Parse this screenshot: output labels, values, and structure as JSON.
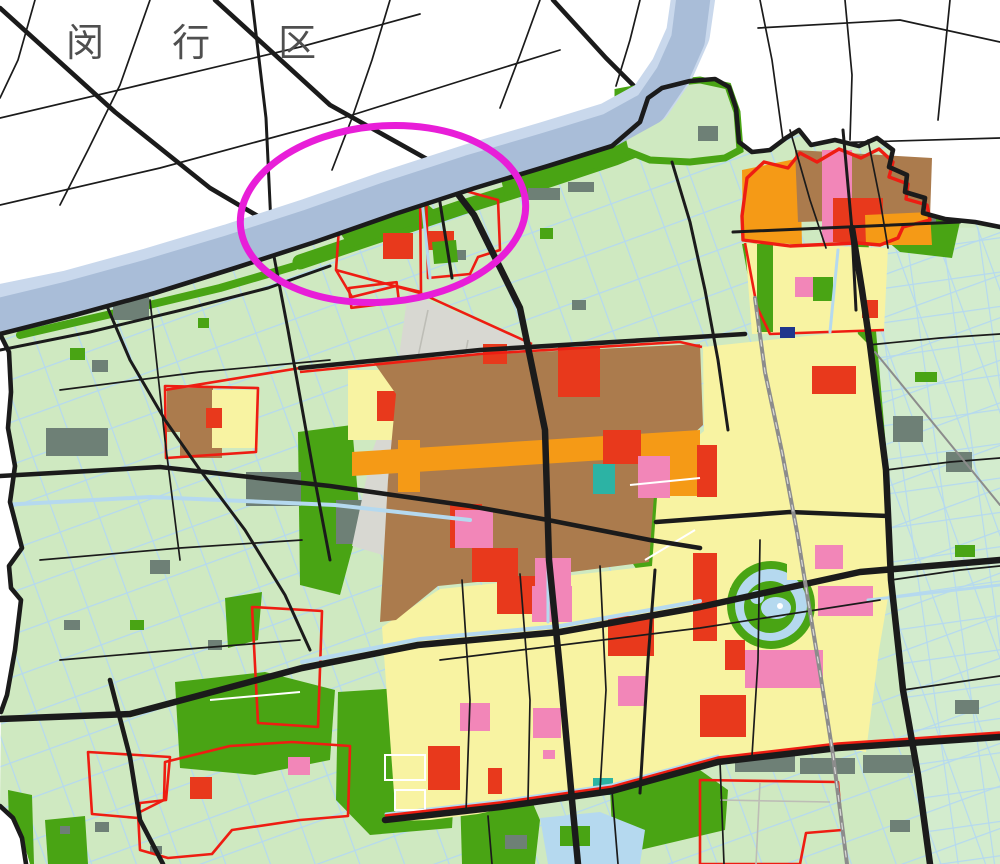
{
  "map": {
    "district_label": "闵 行 区",
    "annotation": "highlight-ellipse"
  },
  "colors": {
    "label": "#4f4f4f",
    "palegreen": "#cfe9c1",
    "palegreen2": "#d3ecce",
    "green": "#49a414",
    "village": "#6e8076",
    "yellow": "#f8f3a2",
    "brown": "#ab7b4d",
    "orange": "#f59a16",
    "red": "#e8391c",
    "pink": "#f286b8",
    "teal": "#2cb3a4",
    "gray": "#d8d8d2",
    "blue": "#20368c",
    "canal": "#b5d9ef",
    "river": "#a9bdd8",
    "riveredge": "#c9d8ec",
    "road": "#1b1b1b",
    "grayroad": "#8c8c8c",
    "redline": "#ee1d12",
    "highlight": "#e81ed8"
  }
}
